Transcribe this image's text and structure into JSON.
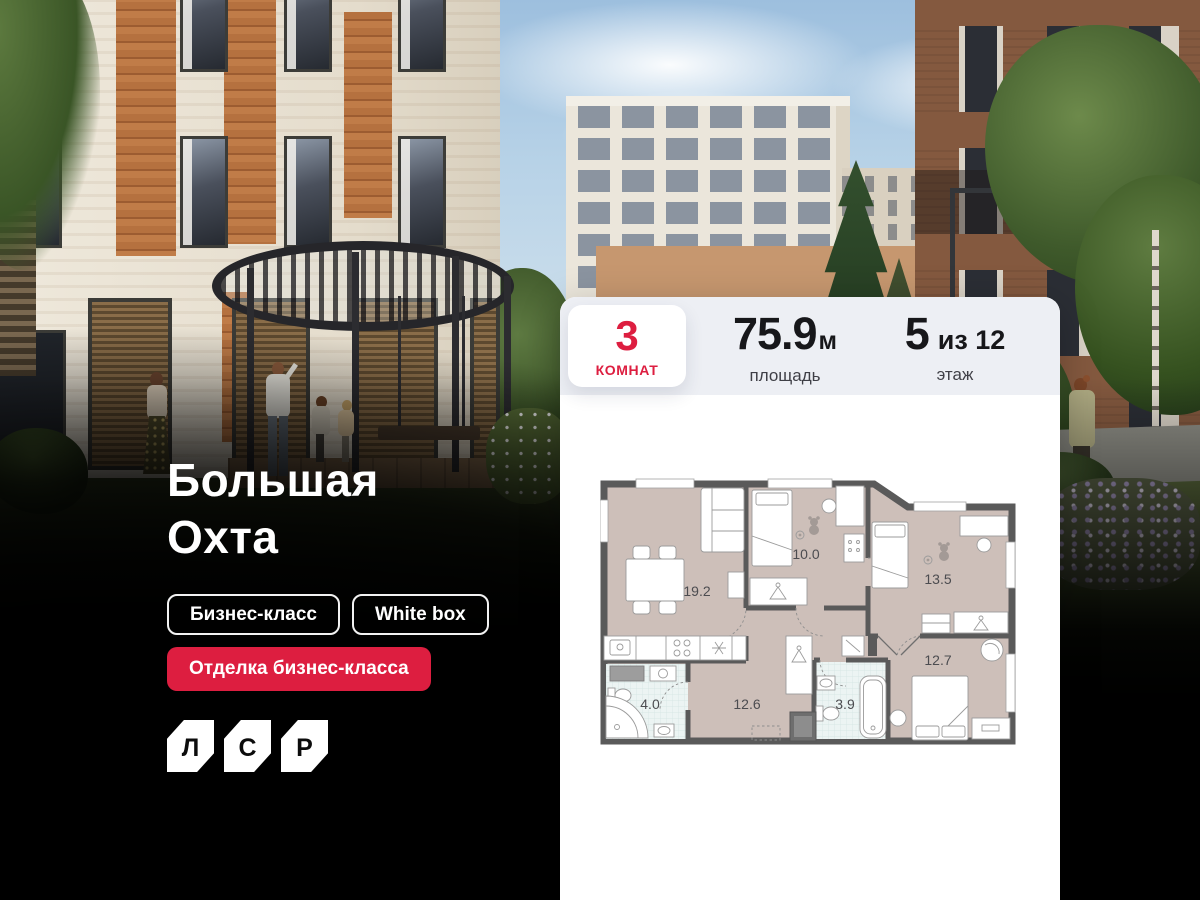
{
  "colors": {
    "accent": "#dd1e40",
    "stats_bar": "#edeff4",
    "plan_wall": "#5a5a5a",
    "plan_room": "#cdbfb9",
    "plan_bath": "#ecf4f3"
  },
  "hero": {
    "title_line1": "Большая",
    "title_line2": "Охта",
    "tags": [
      {
        "label": "Бизнес-класс"
      },
      {
        "label": "White box"
      }
    ],
    "highlight_tag": "Отделка бизнес-класса",
    "logo_letters": [
      "Л",
      "С",
      "Р"
    ]
  },
  "card": {
    "rooms": {
      "value": "3",
      "label": "комнат"
    },
    "area": {
      "value": "75.9",
      "unit": "м",
      "label": "площадь"
    },
    "floor": {
      "value": "5",
      "suffix": "из 12",
      "label": "этаж"
    }
  },
  "floor_plan": {
    "rooms": [
      {
        "name": "living-kitchen",
        "area": "19.2"
      },
      {
        "name": "bedroom-1",
        "area": "10.0"
      },
      {
        "name": "bedroom-2",
        "area": "13.5"
      },
      {
        "name": "bedroom-master",
        "area": "12.7"
      },
      {
        "name": "hallway",
        "area": "12.6"
      },
      {
        "name": "bathroom",
        "area": "4.0"
      },
      {
        "name": "wc",
        "area": "3.9"
      }
    ]
  }
}
